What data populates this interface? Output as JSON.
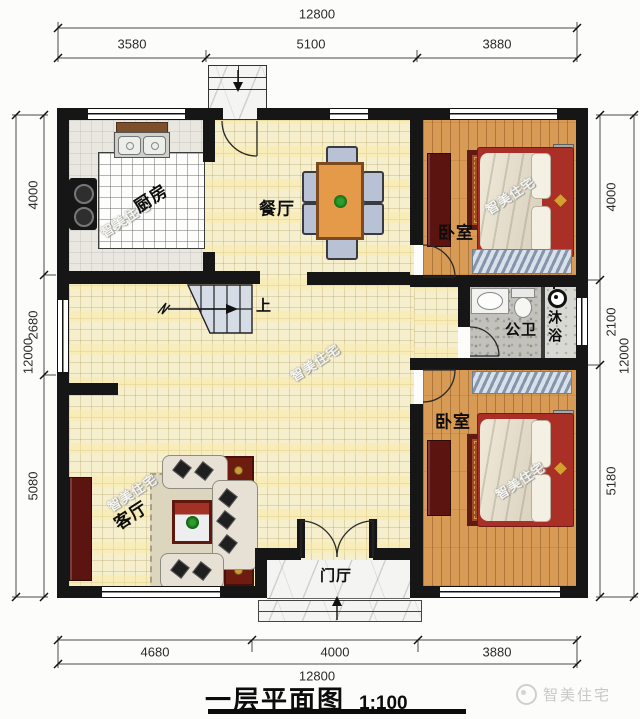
{
  "title": {
    "main": "一层平面图",
    "scale": "1:100"
  },
  "brand": {
    "logo_text": "智美住宅"
  },
  "watermark": {
    "text": "智美住宅"
  },
  "rooms": {
    "kitchen": "厨房",
    "dining": "餐厅",
    "bedroom_top": "卧室",
    "bedroom_bottom": "卧室",
    "bathroom": "公卫",
    "shower": "沐浴",
    "living": "客厅",
    "foyer": "门厅",
    "stairs_up": "上"
  },
  "dimensions": {
    "top": {
      "total": "12800",
      "segments": [
        "3580",
        "5100",
        "3880"
      ]
    },
    "bottom": {
      "total": "12800",
      "segments": [
        "4680",
        "4000",
        "3880"
      ]
    },
    "left": {
      "total": "12000",
      "segments": [
        "4000",
        "2680",
        "5080"
      ]
    },
    "right": {
      "total": "12000",
      "segments": [
        "4000",
        "2100",
        "5180"
      ]
    }
  },
  "colors": {
    "wall": "#161616",
    "floor_tile": "#f6efcd",
    "wood": "#d79b55",
    "marble": "#f4f4f2",
    "bed_red": "#a83026",
    "table_orange": "#e49a48",
    "chair_blue": "#b9c2d4",
    "bath_stone": "#c2c1bb",
    "stair_blue": "#d5dce6",
    "rug_blue": "#b9c7d8"
  }
}
